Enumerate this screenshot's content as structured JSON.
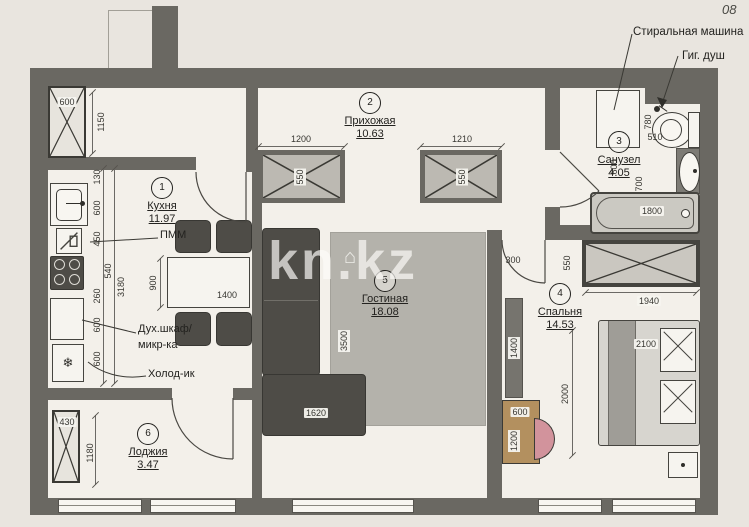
{
  "meta": {
    "corner_note": "08",
    "watermark": "kn.kz"
  },
  "icons": {
    "fridge": "❄",
    "house": "⌂"
  },
  "callouts": {
    "washing_machine": "Стиральная машина",
    "hygienic_shower": "Гиг. душ"
  },
  "rooms": {
    "kitchen": {
      "num": "1",
      "name": "Кухня",
      "area": "11.97"
    },
    "hall": {
      "num": "2",
      "name": "Прихожая",
      "area": "10.63"
    },
    "bath": {
      "num": "3",
      "name": "Санузел",
      "area": "4.05"
    },
    "bedroom": {
      "num": "4",
      "name": "Спальня",
      "area": "14.53"
    },
    "living": {
      "num": "5",
      "name": "Гостиная",
      "area": "18.08"
    },
    "loggia": {
      "num": "6",
      "name": "Лоджия",
      "area": "3.47"
    }
  },
  "labels": {
    "dishwasher": "ПММ",
    "oven_line1": "Дух.шкаф/",
    "oven_line2": "микр-ка",
    "fridge": "Холод-ик"
  },
  "dims": {
    "kitchen_vent_w": "600",
    "kitchen_entry_h": "1150",
    "counter_gap": "130",
    "counter_sink": "600",
    "counter_dw": "450",
    "counter_stove": "540",
    "counter_mid": "260",
    "kitchen_len": "3180",
    "counter_oven": "600",
    "counter_fridge": "600",
    "table_len": "1400",
    "table_dep": "900",
    "closet_left_w": "1200",
    "closet_left_d": "550",
    "closet_right_w": "1210",
    "closet_right_d": "550",
    "bath_pass": "510",
    "toilet_w": "780",
    "bath_a": "600",
    "bath_b": "700",
    "tub_len": "1800",
    "bedroom_pass": "300",
    "wardrobe_d": "550",
    "wardrobe_len": "1940",
    "bed_len": "2000",
    "bed_w": "2100",
    "tv_unit": "1400",
    "desk_d": "600",
    "desk_len": "1200",
    "rug_len": "3500",
    "sofa_len": "1620",
    "loggia_vent": "430",
    "loggia_d": "1180"
  }
}
